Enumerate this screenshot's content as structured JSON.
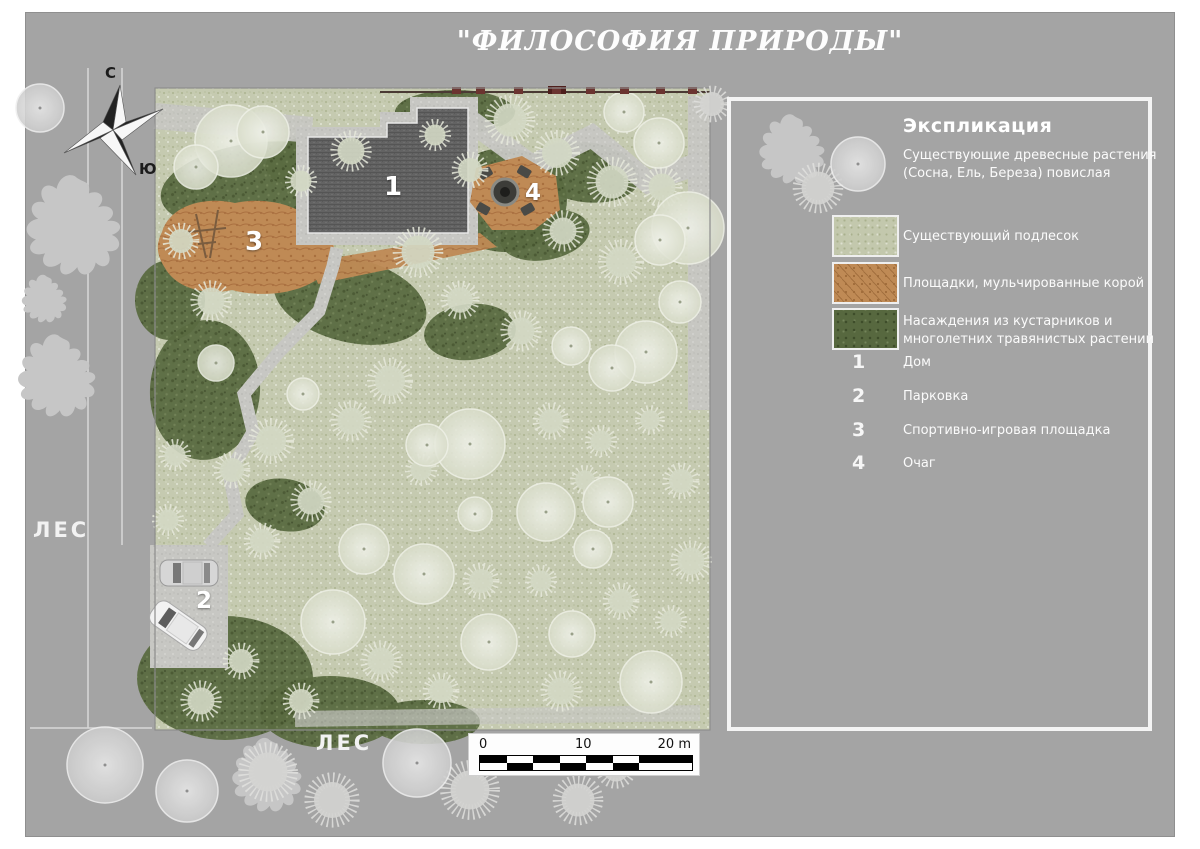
{
  "title": "\"ФИЛОСОФИЯ ПРИРОДЫ\"",
  "compass": {
    "north": "С",
    "south": "Ю"
  },
  "labels": {
    "forest_left": "ЛЕС",
    "forest_bottom": "ЛЕС"
  },
  "legend": {
    "title": "Экспликация",
    "tree_item": {
      "symbol": "existing-tree-circle",
      "text": "Существующие древесные растения (Сосна, Ель, Береза) повислая"
    },
    "swatch_items": [
      {
        "name": "underbrush",
        "color": "#c3c8ad",
        "text": "Существующий подлесок"
      },
      {
        "name": "bark-mulch",
        "color": "#bf8a55",
        "text": "Площадки, мульчированные корой"
      },
      {
        "name": "shrub-perennial",
        "color": "#57683f",
        "text": "Насаждения из кустарников и многолетних травянистых растений"
      }
    ],
    "numbered_items": [
      {
        "num": "1",
        "label": "Дом"
      },
      {
        "num": "2",
        "label": "Парковка"
      },
      {
        "num": "3",
        "label": "Спортивно-игровая площадка"
      },
      {
        "num": "4",
        "label": "Очаг"
      }
    ]
  },
  "scale_bar": {
    "tick0": "0",
    "tick10": "10",
    "tick20": "20 m"
  },
  "plan_markers": [
    {
      "num": "1",
      "x": 393,
      "y": 187,
      "size": 26
    },
    {
      "num": "2",
      "x": 204,
      "y": 601,
      "size": 23
    },
    {
      "num": "3",
      "x": 254,
      "y": 242,
      "size": 26
    },
    {
      "num": "4",
      "x": 533,
      "y": 193,
      "size": 23
    }
  ],
  "colors": {
    "page_gray": "#a4a4a4",
    "plan_base": "#c5cab0",
    "mulch": "#bf8a55",
    "dark_planting": "#57683f",
    "path": "#c7c7c3",
    "roof": "#616161",
    "fence_post": "#6b3430",
    "text_white": "#fbfbfb"
  },
  "map_features": {
    "shrub_patches": [
      [
        255,
        185,
        95,
        42,
        -8
      ],
      [
        350,
        300,
        78,
        42,
        14
      ],
      [
        470,
        332,
        46,
        28,
        -6
      ],
      [
        205,
        390,
        55,
        70,
        4
      ],
      [
        505,
        200,
        62,
        52,
        0
      ],
      [
        585,
        172,
        55,
        30,
        8
      ],
      [
        545,
        235,
        45,
        25,
        -10
      ],
      [
        225,
        678,
        88,
        62,
        0
      ],
      [
        330,
        712,
        70,
        36,
        0
      ],
      [
        425,
        722,
        55,
        22,
        0
      ],
      [
        285,
        505,
        40,
        26,
        10
      ],
      [
        170,
        300,
        35,
        40,
        0
      ],
      [
        455,
        112,
        60,
        22,
        0
      ],
      [
        310,
        160,
        45,
        25,
        -12
      ]
    ],
    "trees_smooth": [
      [
        231,
        141,
        36
      ],
      [
        263,
        132,
        26
      ],
      [
        196,
        167,
        22
      ],
      [
        688,
        228,
        36
      ],
      [
        660,
        240,
        25
      ],
      [
        646,
        352,
        31
      ],
      [
        612,
        368,
        23
      ],
      [
        470,
        444,
        35
      ],
      [
        546,
        512,
        29
      ],
      [
        608,
        502,
        25
      ],
      [
        424,
        574,
        30
      ],
      [
        333,
        622,
        32
      ],
      [
        489,
        642,
        28
      ],
      [
        572,
        634,
        23
      ],
      [
        651,
        682,
        31
      ],
      [
        364,
        549,
        25
      ],
      [
        593,
        549,
        19
      ],
      [
        475,
        514,
        17
      ],
      [
        303,
        394,
        16
      ],
      [
        216,
        363,
        18
      ],
      [
        680,
        302,
        21
      ],
      [
        659,
        143,
        25
      ],
      [
        624,
        112,
        20
      ],
      [
        427,
        445,
        21
      ],
      [
        571,
        346,
        19
      ]
    ],
    "shrubs_spiky": [
      [
        510,
        120,
        22
      ],
      [
        557,
        153,
        20
      ],
      [
        612,
        182,
        22
      ],
      [
        662,
        187,
        18
      ],
      [
        563,
        231,
        18
      ],
      [
        621,
        262,
        20
      ],
      [
        460,
        300,
        17
      ],
      [
        521,
        331,
        18
      ],
      [
        390,
        381,
        20
      ],
      [
        351,
        421,
        18
      ],
      [
        271,
        441,
        20
      ],
      [
        232,
        470,
        16
      ],
      [
        311,
        501,
        18
      ],
      [
        262,
        541,
        16
      ],
      [
        421,
        470,
        14
      ],
      [
        551,
        421,
        16
      ],
      [
        601,
        441,
        14
      ],
      [
        481,
        581,
        16
      ],
      [
        541,
        581,
        14
      ],
      [
        381,
        661,
        18
      ],
      [
        441,
        691,
        16
      ],
      [
        561,
        691,
        18
      ],
      [
        621,
        601,
        16
      ],
      [
        211,
        301,
        18
      ],
      [
        181,
        241,
        16
      ],
      [
        351,
        151,
        18
      ],
      [
        301,
        181,
        14
      ],
      [
        681,
        481,
        16
      ],
      [
        691,
        561,
        18
      ],
      [
        671,
        621,
        14
      ],
      [
        241,
        661,
        16
      ],
      [
        201,
        701,
        18
      ],
      [
        301,
        701,
        16
      ],
      [
        418,
        252,
        22
      ],
      [
        470,
        170,
        16
      ],
      [
        435,
        135,
        14
      ],
      [
        175,
        455,
        14
      ],
      [
        168,
        520,
        14
      ],
      [
        650,
        420,
        13
      ],
      [
        585,
        480,
        13
      ]
    ],
    "trees_outside_smooth": [
      [
        105,
        765,
        38
      ],
      [
        187,
        791,
        31
      ],
      [
        417,
        763,
        34
      ],
      [
        40,
        108,
        24
      ],
      [
        858,
        164,
        27
      ]
    ],
    "shrubs_outside_spiky": [
      [
        268,
        772,
        26
      ],
      [
        332,
        800,
        24
      ],
      [
        470,
        790,
        26
      ],
      [
        578,
        800,
        22
      ],
      [
        616,
        768,
        18
      ],
      [
        712,
        104,
        16
      ],
      [
        818,
        188,
        22
      ]
    ],
    "branchy_trees": [
      [
        75,
        228,
        1.15
      ],
      [
        58,
        378,
        0.95
      ],
      [
        45,
        300,
        0.55
      ],
      [
        268,
        777,
        0.85
      ],
      [
        793,
        151,
        0.8
      ]
    ],
    "fence_posts_x": [
      452,
      476,
      514,
      552,
      586,
      620,
      656,
      688
    ]
  }
}
